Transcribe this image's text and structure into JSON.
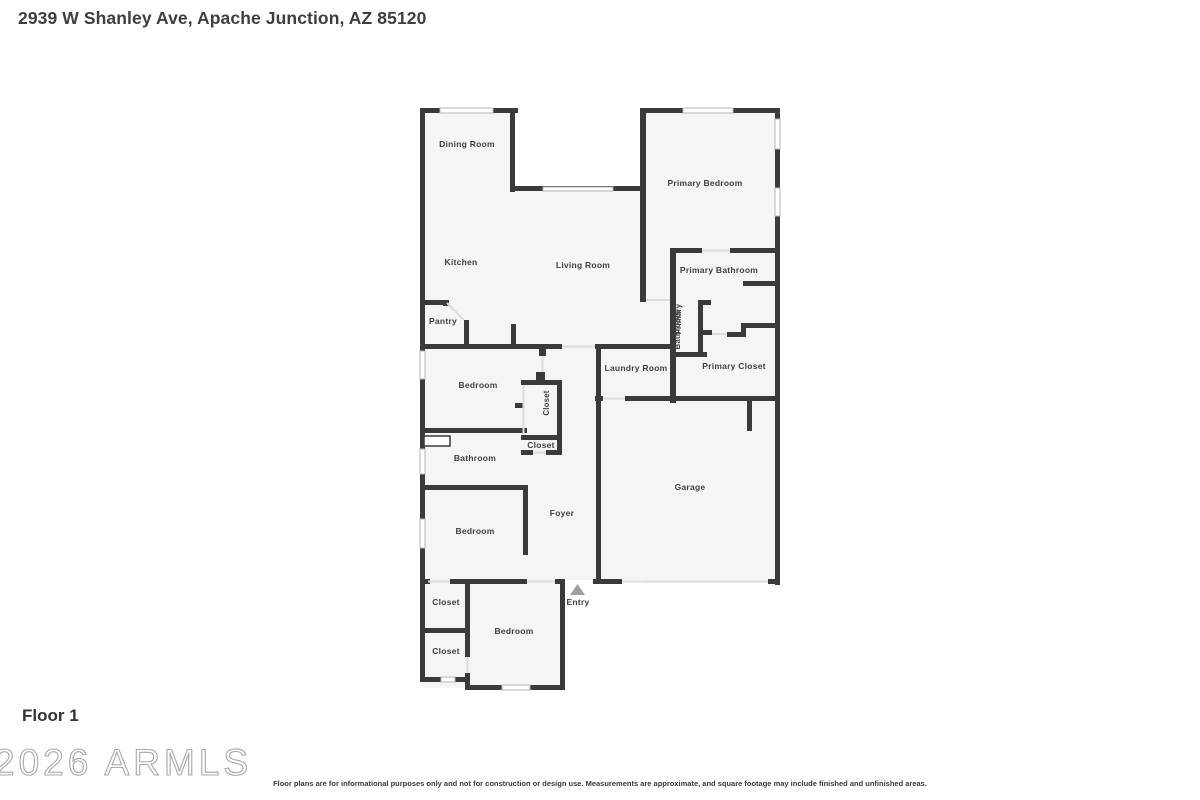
{
  "page": {
    "title": "2939 W Shanley Ave, Apache Junction, AZ 85120"
  },
  "floorplan": {
    "floor_label": "Floor 1",
    "labels": {
      "dining_room": "Dining Room",
      "primary_bedroom": "Primary Bedroom",
      "kitchen": "Kitchen",
      "living_room": "Living Room",
      "primary_bathroom": "Primary Bathroom",
      "primary_bathroom_hall_line1": "Primary",
      "primary_bathroom_hall_line2": "Bathroom",
      "pantry": "Pantry",
      "laundry_room": "Laundry Room",
      "primary_closet": "Primary Closet",
      "bedroom_1": "Bedroom",
      "closet_1": "Closet",
      "closet_2": "Closet",
      "bathroom": "Bathroom",
      "garage": "Garage",
      "foyer": "Foyer",
      "bedroom_2": "Bedroom",
      "closet_3": "Closet",
      "closet_4": "Closet",
      "bedroom_3": "Bedroom",
      "entry": "Entry"
    }
  },
  "footer": {
    "watermark": "2026 ARMLS",
    "disclaimer": "Floor plans are for informational purposes only and not for construction or design use. Measurements are approximate, and square footage may include finished and unfinished areas."
  },
  "colors": {
    "wall": "#3a3a3a",
    "floor": "#f5f5f5",
    "opening": "#dcdcdc",
    "window_frame": "#b5b5b5",
    "label": "#3f3f3f",
    "arrow": "#a0a0a0",
    "title": "#3e3e3e",
    "watermark": "#a8a8a8"
  }
}
